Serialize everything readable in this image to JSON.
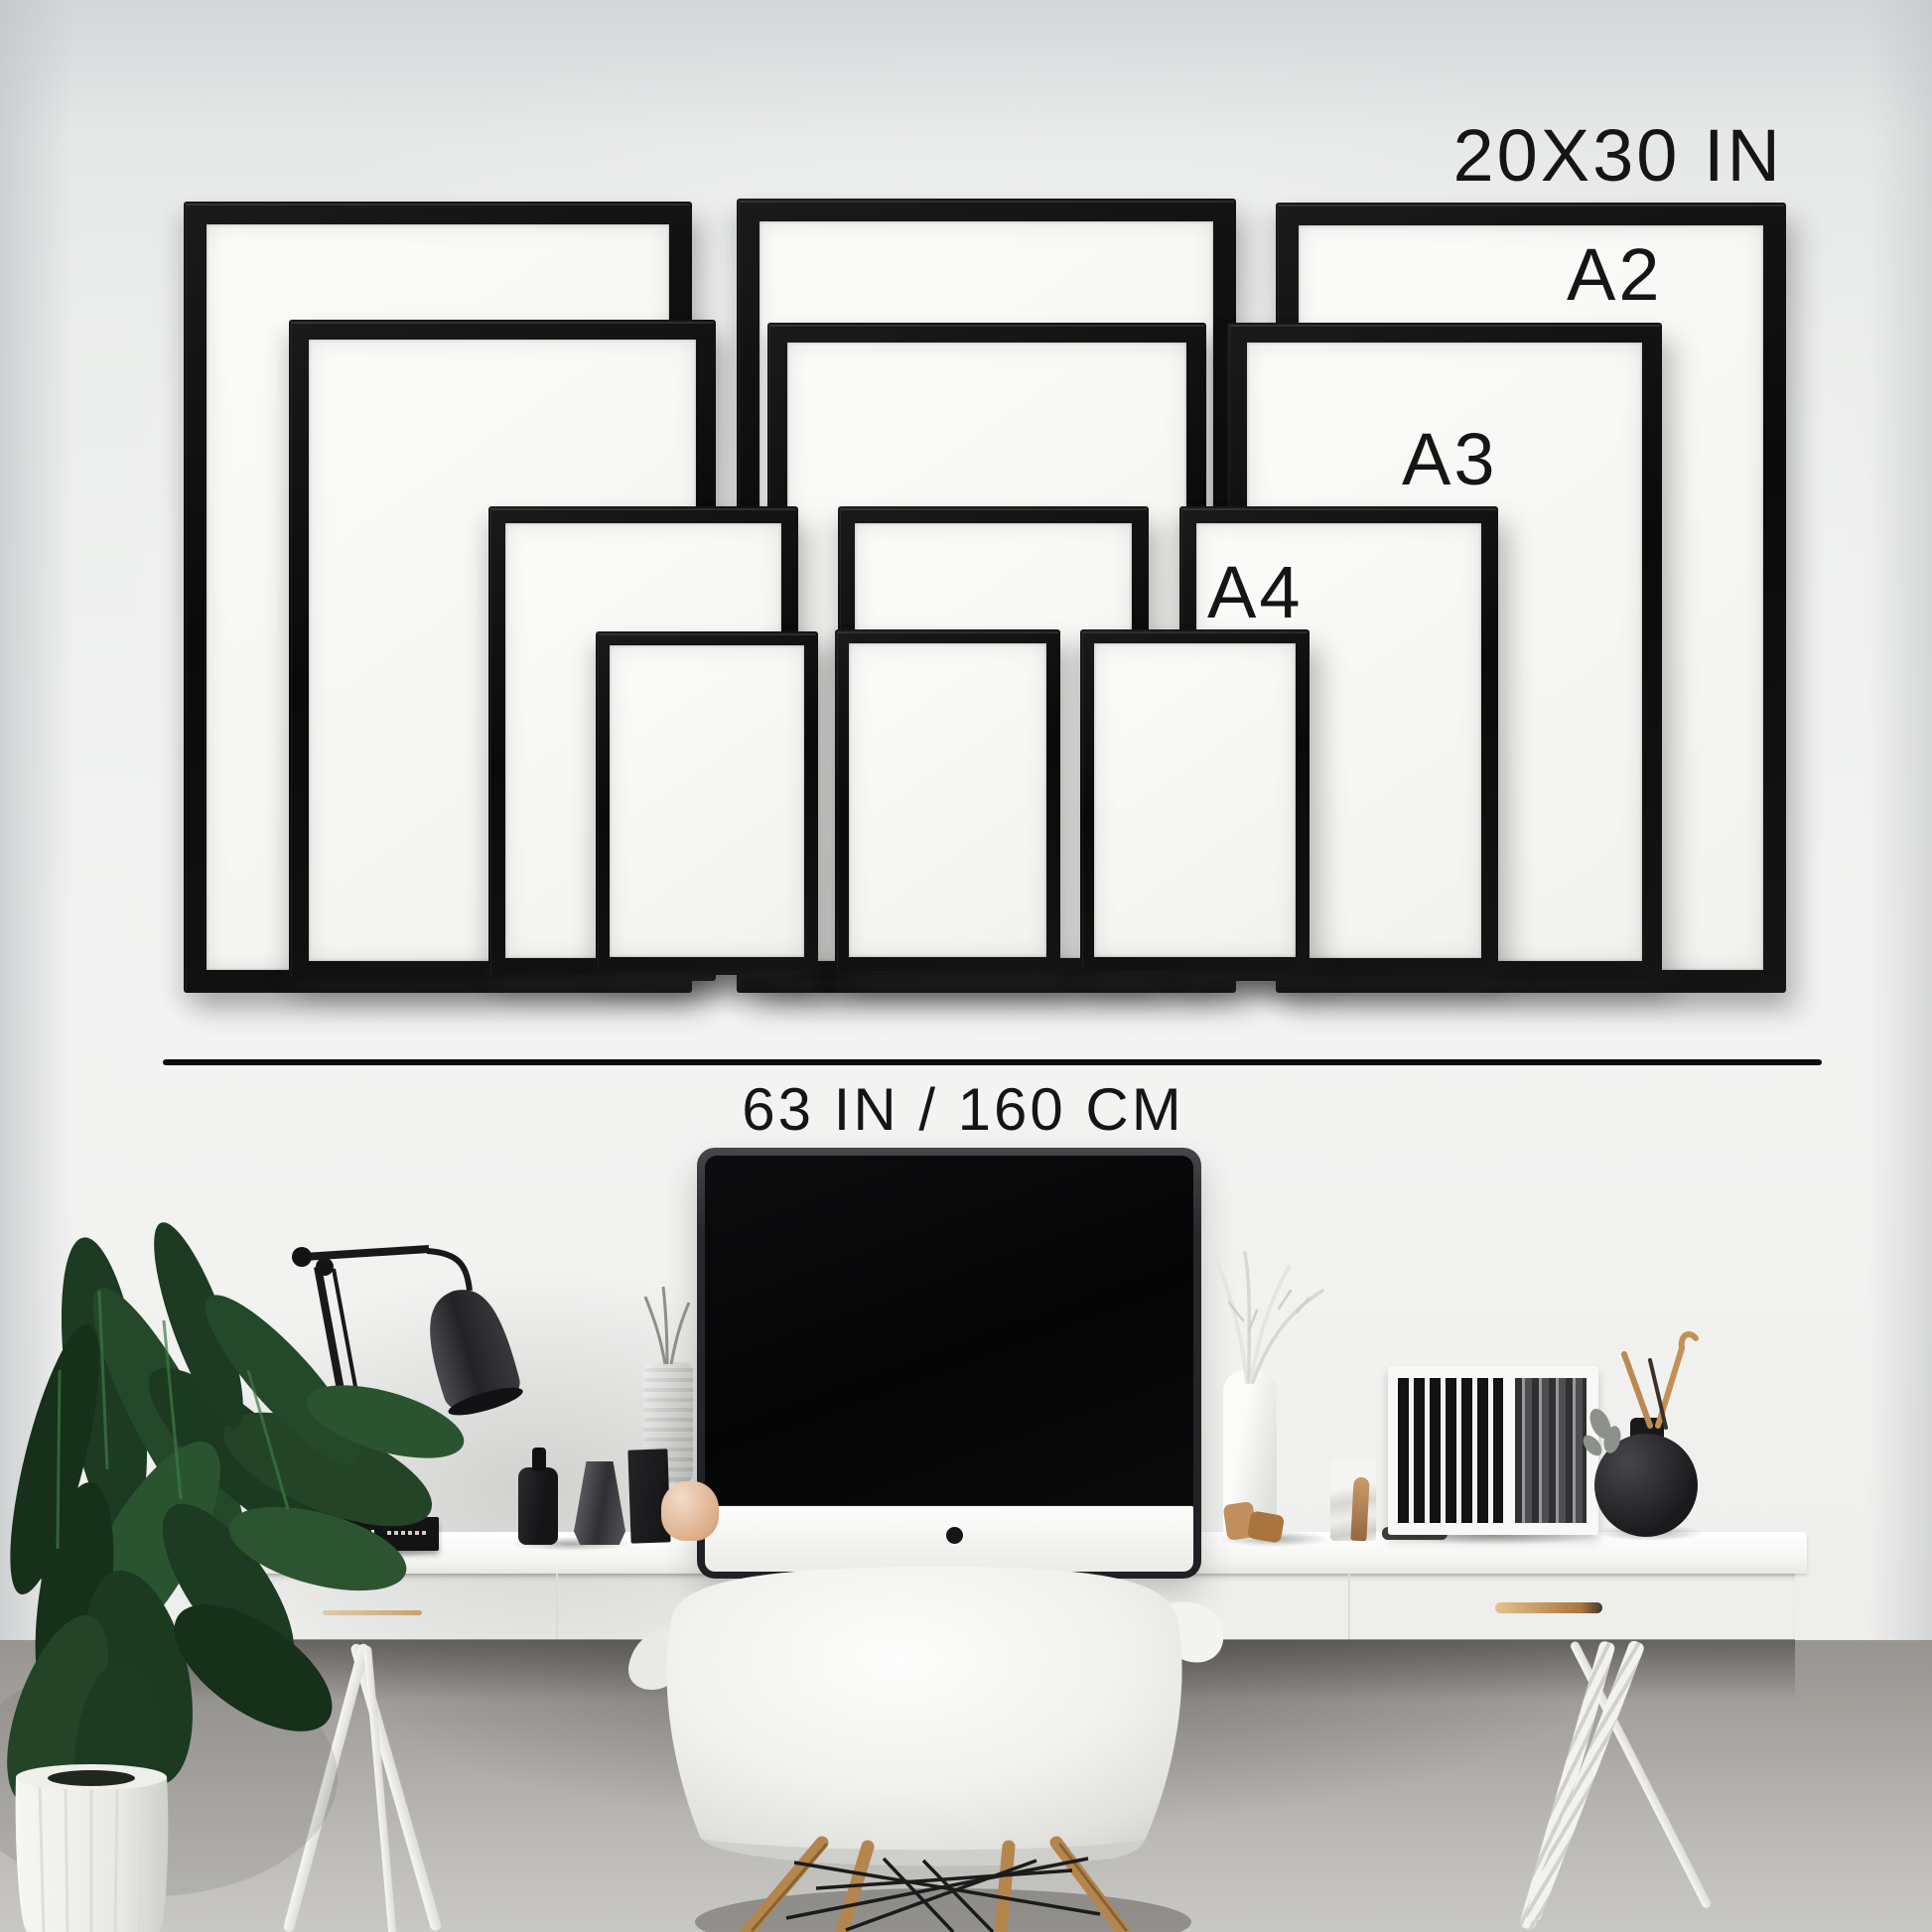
{
  "size_guide": {
    "largest_size_label": "20X30 IN",
    "a2_label": "A2",
    "a3_label": "A3",
    "a4_label": "A4",
    "wall_width_label": "63 IN / 160 CM"
  },
  "palette": {
    "frame_black": "#0e0e0e",
    "matte_white": "#f7f7f4",
    "label_text": "#151515",
    "wall_gray": "#f0f1f0",
    "desk_white": "#f7f7f5",
    "wood_tan": "#b5854e",
    "handle_brass": "#c9a36a",
    "plant_green": "#22422a",
    "peach": "#ddb08a"
  },
  "objects": {
    "monitor": "imac-monitor",
    "lamp": "black-desk-lamp",
    "chair": "white-shell-armchair",
    "plant": "potted-palm-plant",
    "storage": "file-box-with-black-spines",
    "vase": "black-sphere-vase"
  }
}
